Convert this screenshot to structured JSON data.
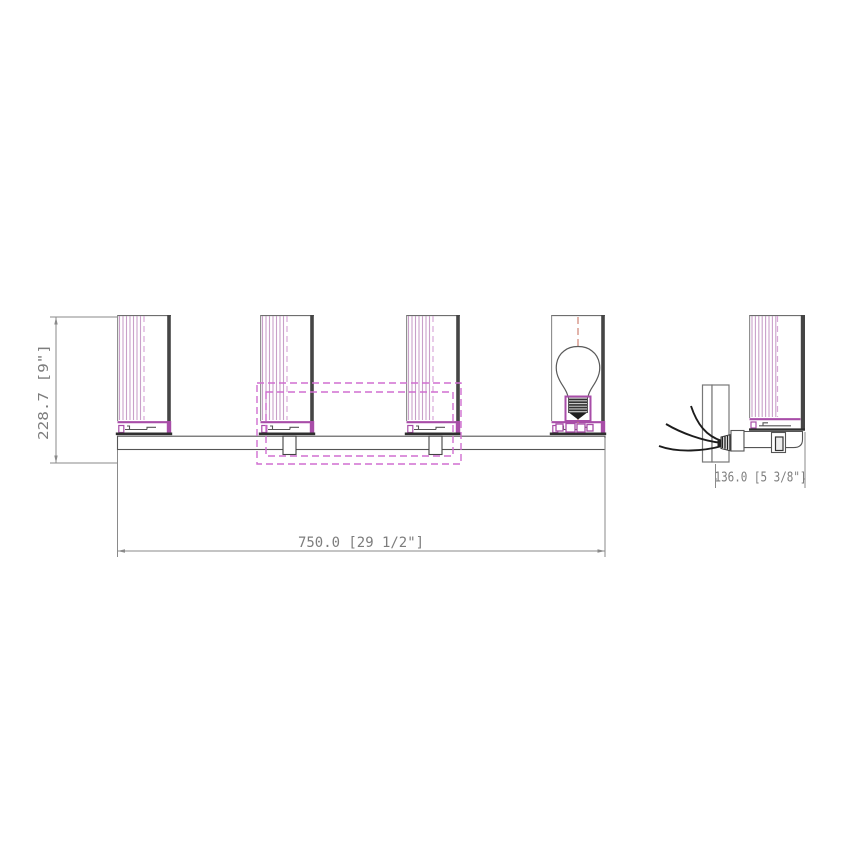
{
  "drawing": {
    "kind": "technical-dimension-drawing",
    "subject": "4-light bath vanity wall fixture, front and side elevation",
    "views": {
      "front": {
        "shade_count": 4,
        "components": [
          "glass-shade",
          "lamp-holder",
          "light-bulb",
          "mounting-bar",
          "stem",
          "backplate-dashed-outline"
        ]
      },
      "side": {
        "components": [
          "wall-plate",
          "supply-wires",
          "strain-relief",
          "socket-arm",
          "glass-shade-profile",
          "stem"
        ]
      }
    },
    "dimensions": {
      "height": {
        "value_mm": "228.7",
        "value_in": "9\"",
        "label": "228.7 [9\"]"
      },
      "width": {
        "value_mm": "750.0",
        "value_in": "29 1/2\"",
        "label": "750.0 [29 1/2\"]"
      },
      "depth": {
        "value_mm": "136.0",
        "value_in": "5 3/8\"",
        "label": "136.0 [5 3/8\"]"
      }
    },
    "colors": {
      "line": "#6e6e6e",
      "dark_edge": "#454545",
      "magenta": "#a84da8",
      "hatch": "#c9a0c9",
      "dashed_outline": "#d06ed0",
      "centerline_red": "#cf8273",
      "dim_text": "#7d7d7d",
      "background": "#ffffff"
    }
  }
}
